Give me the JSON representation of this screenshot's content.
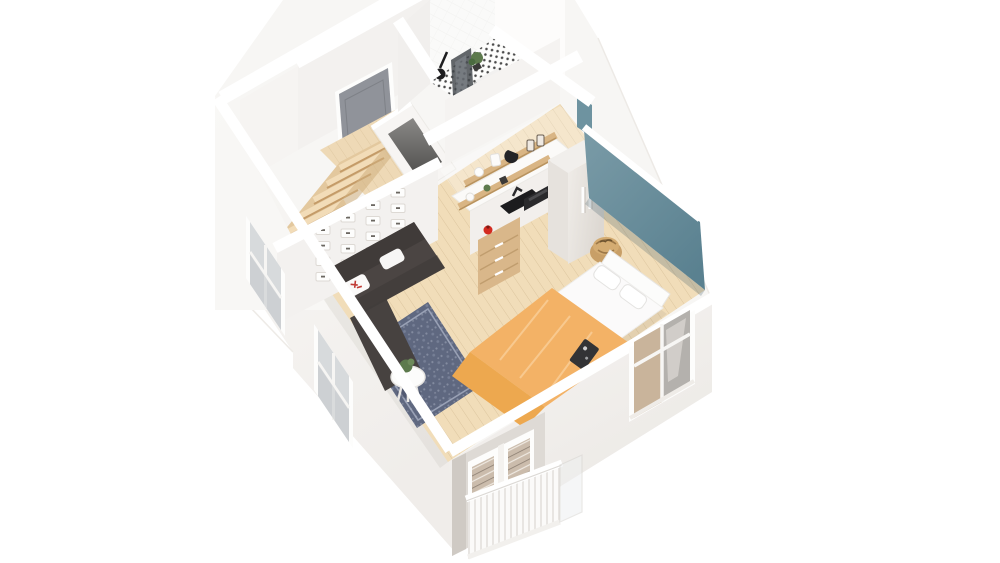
{
  "scene": {
    "kind": "3d-apartment-floorplan-render",
    "view": "isometric-cutaway-top-down",
    "rooms": [
      {
        "name": "bathroom",
        "features": [
          "shower-glass-panel",
          "shower-head",
          "toilet",
          "washbasin",
          "plant",
          "dotted-tile-floor"
        ]
      },
      {
        "name": "entry-hall",
        "features": [
          "front-door",
          "staircase",
          "closet-shaft"
        ]
      },
      {
        "name": "kitchen",
        "features": [
          "counter-with-sink",
          "wood-drawers",
          "wall-shelves",
          "microwave",
          "wardrobe-fridge",
          "red-kettle"
        ]
      },
      {
        "name": "living-area",
        "features": [
          "charcoal-sofa",
          "white-pillows",
          "blue-rug",
          "round-side-table",
          "plant",
          "panel-wall"
        ]
      },
      {
        "name": "sleeping-area",
        "features": [
          "double-bed",
          "orange-blanket",
          "pillows",
          "woven-basket-table",
          "teal-accent-wall"
        ]
      },
      {
        "name": "exterior",
        "features": [
          "window-left-upper",
          "window-left-lower",
          "window-front-right",
          "balcony-french-door",
          "balcony-railing"
        ]
      }
    ]
  },
  "palette": {
    "background": "#ffffff",
    "wall_light": "#f7f6f4",
    "wall_face_sw": "#f6f4f2",
    "wall_face_nw": "#f3f1ef",
    "wall_shade": "#efece9",
    "wall_shadow": "#e7e3df",
    "accent_teal": "#6e93a0",
    "teal_dark": "#5a8190",
    "wood_floor": "#f1ddb9",
    "wood_hall": "#eed9b6",
    "wood_stairs": "#e3c89e",
    "wood_shelf": "#d9b584",
    "wood_drawers": "#d9b78a",
    "sofa": "#4b4543",
    "sofa_cushion": "#403b39",
    "rug": "#5f6880",
    "blanket": "#f3b266",
    "blanket_fold": "#eda84f",
    "bed_white": "#fbfafa",
    "door_gray": "#90939a",
    "glass": "#d7dadc",
    "glass_warm": "#c9b49b",
    "sink_black": "#1c1c1e",
    "kettle_red": "#d32b20",
    "basket": "#c89f67",
    "shaft_floor": "#6f6e6c",
    "plant_green": "#5d7a4d",
    "counter_white": "#fbfaf8",
    "shower_glass": "#41454b",
    "railing_white": "#fbfaf9"
  },
  "panels_grid": {
    "cols": 4,
    "rows": 4
  },
  "stairs": {
    "steps": 6
  },
  "balcony": {
    "door_panes_per_leaf": 5
  }
}
